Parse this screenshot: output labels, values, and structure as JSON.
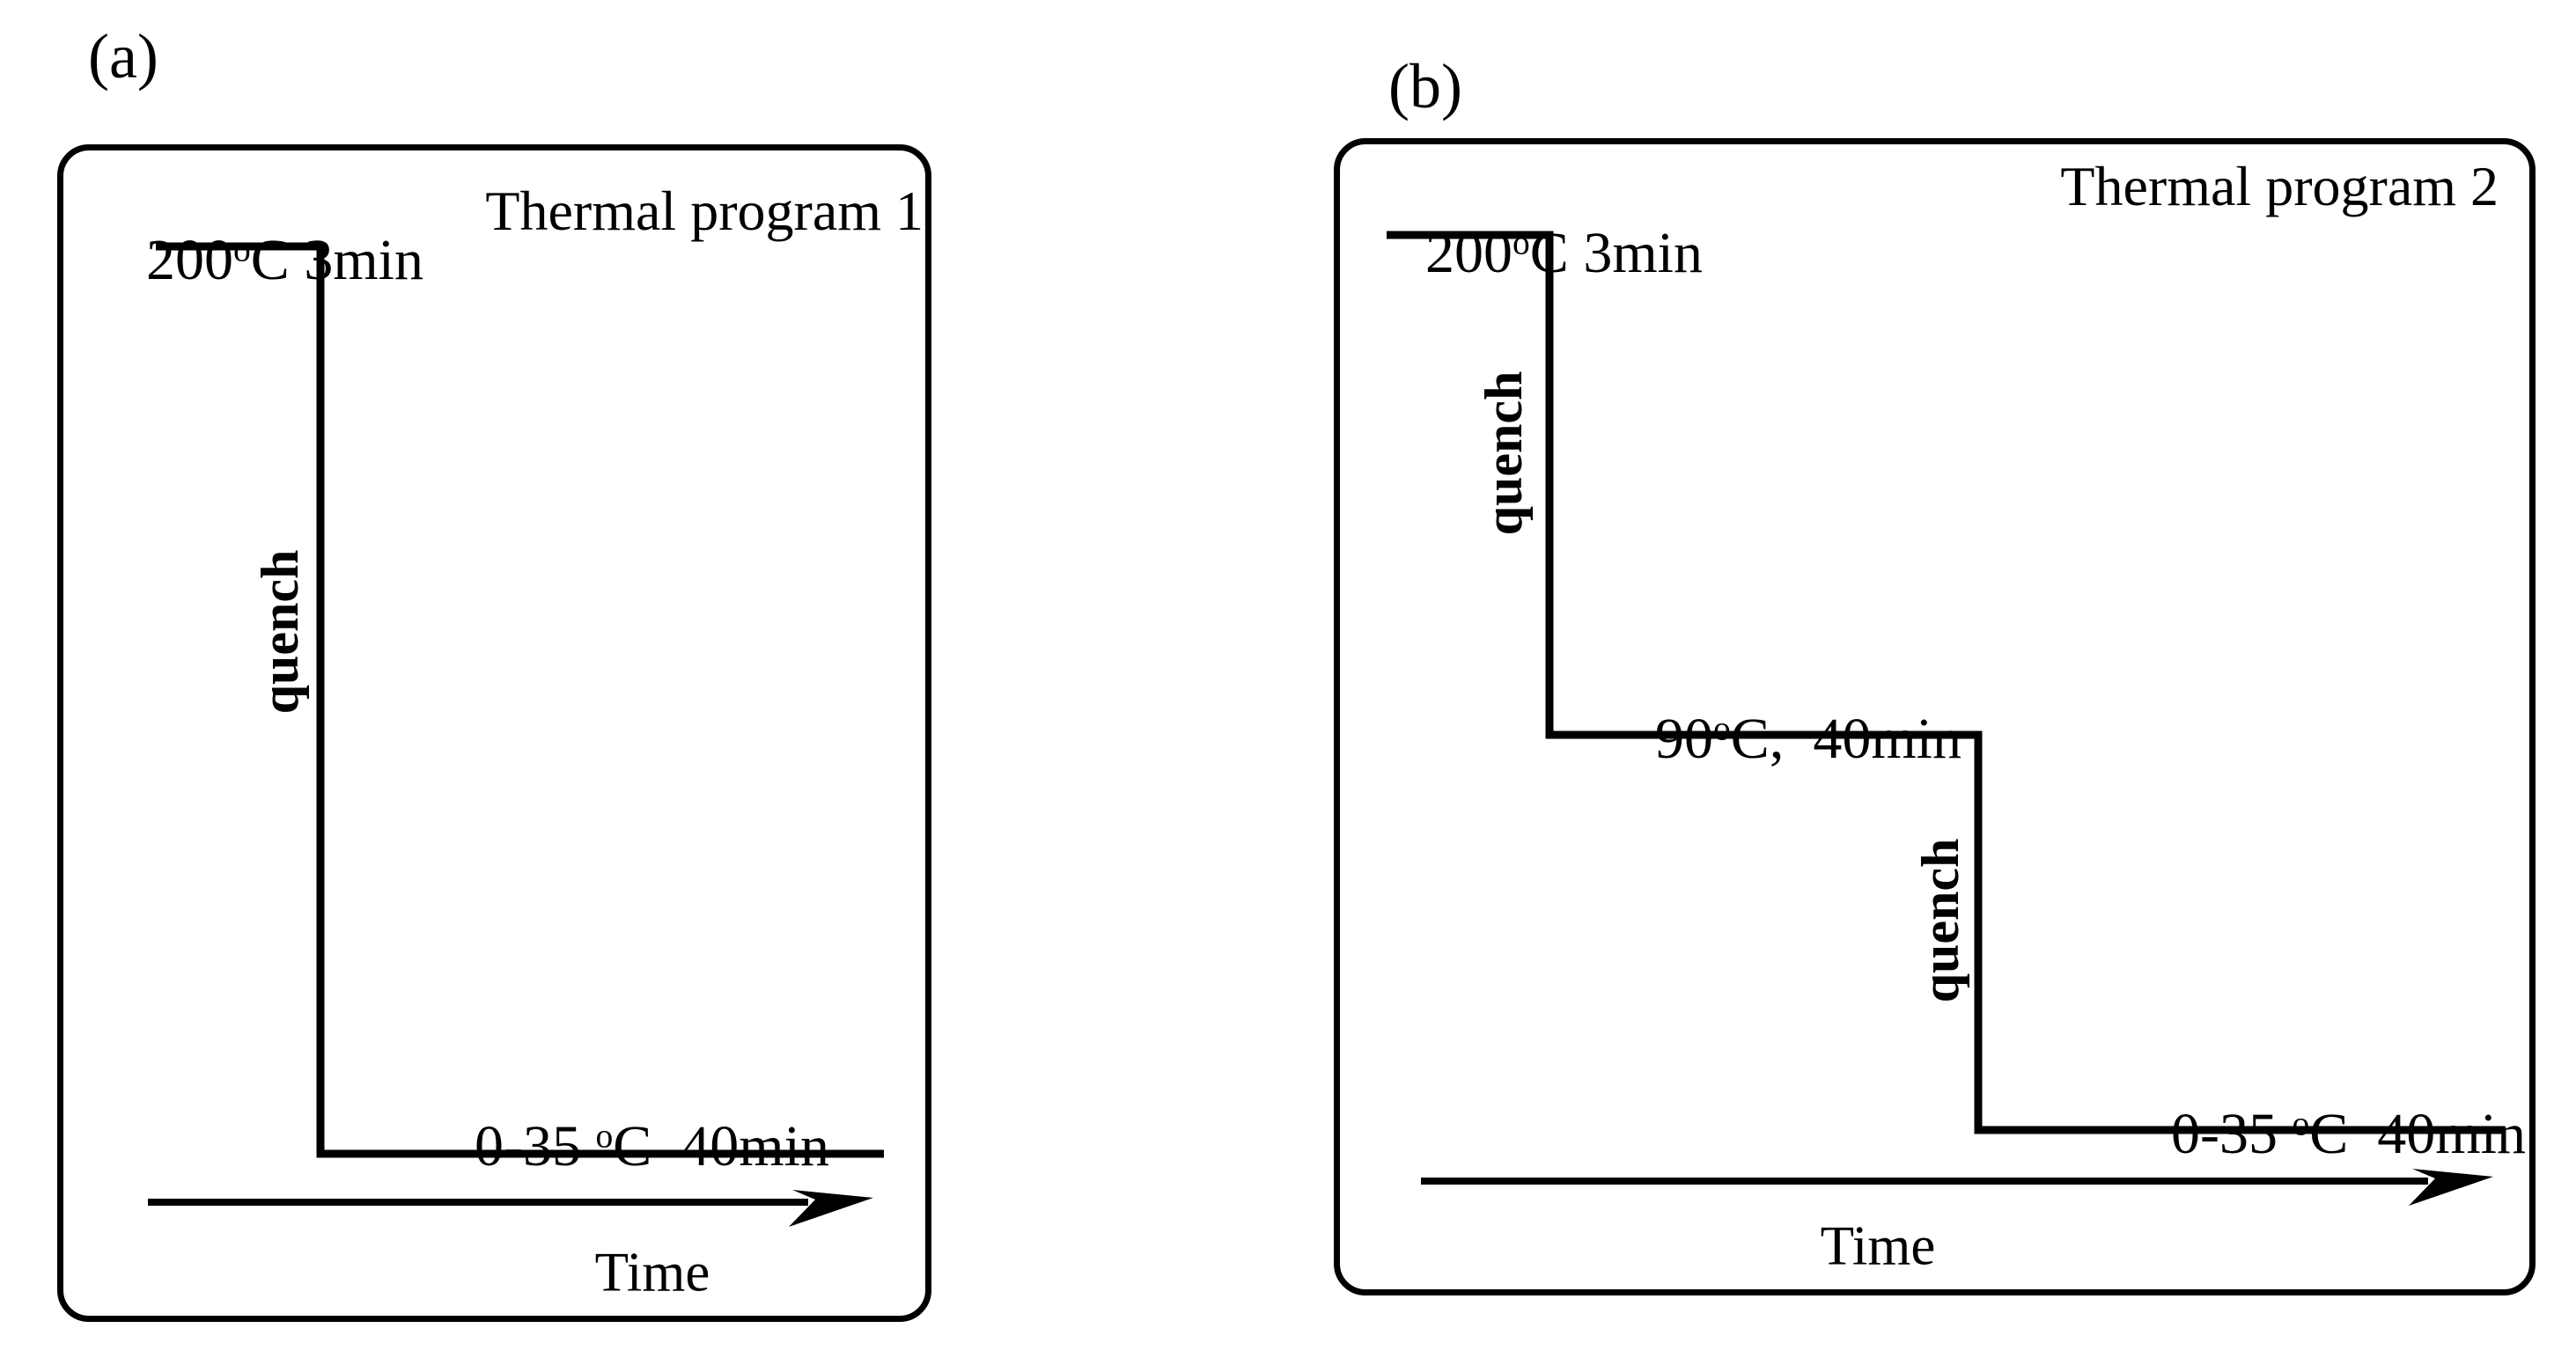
{
  "figure": {
    "background_color": "#ffffff",
    "line_color": "#000000",
    "panels": [
      {
        "label": "(a)",
        "title": "Thermal program 1",
        "time_axis_label": "Time",
        "steps": {
          "top": {
            "value": "200",
            "sup": "o",
            "unit": "C 3min"
          },
          "bottom": {
            "value": "0-35 ",
            "sup": "o",
            "unit": "C  40min"
          }
        },
        "quench": [
          "quench"
        ]
      },
      {
        "label": "(b)",
        "title": "Thermal program 2",
        "time_axis_label": "Time",
        "steps": {
          "top": {
            "value": "200",
            "sup": "o",
            "unit": "C 3min"
          },
          "middle": {
            "value": "90",
            "sup": "o",
            "unit": "C,  40min"
          },
          "bottom": {
            "value": "0-35 ",
            "sup": "o",
            "unit": "C  40min"
          }
        },
        "quench": [
          "quench",
          "quench"
        ]
      }
    ]
  }
}
